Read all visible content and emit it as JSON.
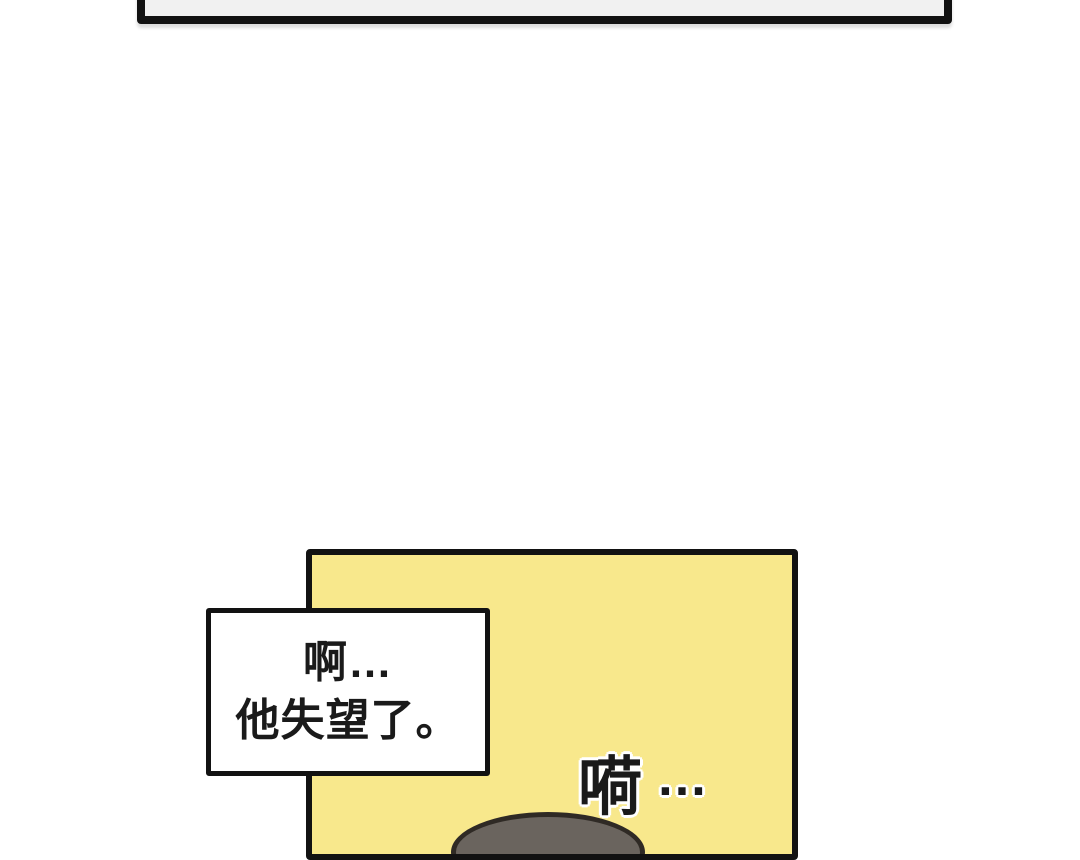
{
  "meta": {
    "kind": "webtoon-comic-page"
  },
  "colors": {
    "page_bg": "#ffffff",
    "panel_border": "#121212",
    "top_panel_fill": "#f1f1f1",
    "main_panel_fill": "#f8e88c",
    "narration_fill": "#ffffff",
    "text": "#1a1a1a",
    "sfx_outline": "#ffffff",
    "head_fill": "#6a645e",
    "head_outline": "#2f2a25"
  },
  "narration_box": {
    "line1": "啊…",
    "line2": "他失望了。"
  },
  "sfx": {
    "char": "嗬",
    "ellipsis": "…"
  }
}
